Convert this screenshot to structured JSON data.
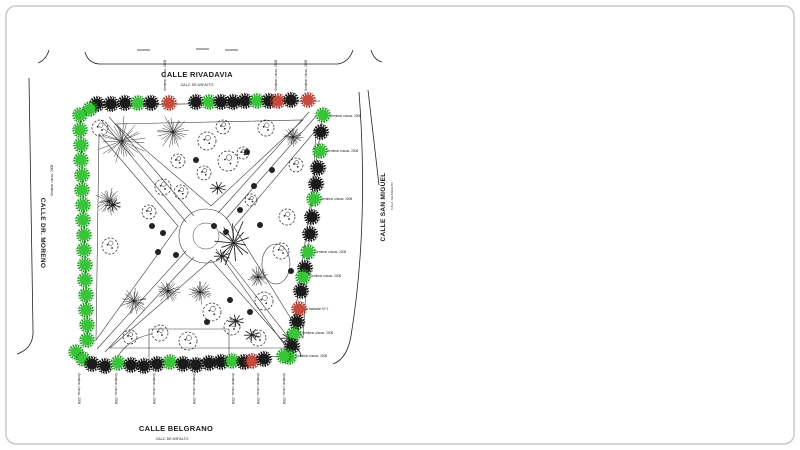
{
  "figure": {
    "palette": {
      "ink": "#222222",
      "faint": "#8a8a8a",
      "frame": "#c9c9c9",
      "K": {
        "fill": "#1b1b1b",
        "ring": "#000000"
      },
      "G": {
        "fill": "#38c53a",
        "ring": "#128a12"
      },
      "R": {
        "fill": "#c74a3c",
        "ring": "#8e2c1f"
      }
    },
    "streets": {
      "north": {
        "name": "CALLE RIVADAVIA",
        "subtitle": "CALZ. DE ASFALTO",
        "x": 197,
        "y": 77,
        "subx": 197,
        "suby": 86
      },
      "south": {
        "name": "CALLE BELGRANO",
        "subtitle": "CALZ. DE ASFALTO",
        "x": 176,
        "y": 431,
        "subx": 172,
        "suby": 440
      },
      "east": {
        "name": "CALLE SAN MIGUEL",
        "subtitle": "CALZ. DE ASFALTO",
        "x": 385,
        "y": 207,
        "subx": 393,
        "suby": 196
      },
      "west": {
        "name": "CALLE DR. MORENO",
        "subtitle": "",
        "x": 41,
        "y": 233,
        "subx": 0,
        "suby": 0
      }
    },
    "annotations": {
      "plant_label": "Sembrar c/acac. 2008",
      "transplant_label": "A trasladar Nº 2"
    },
    "perimeter_trees": {
      "top": [
        [
          97,
          104,
          "K"
        ],
        [
          111,
          104,
          "K"
        ],
        [
          125,
          103,
          "K"
        ],
        [
          138,
          103,
          "G"
        ],
        [
          151,
          103,
          "K"
        ],
        [
          169,
          103,
          "R"
        ],
        [
          196,
          102,
          "K"
        ],
        [
          209,
          102,
          "G"
        ],
        [
          221,
          102,
          "K"
        ],
        [
          233,
          102,
          "K"
        ],
        [
          245,
          101,
          "K"
        ],
        [
          257,
          101,
          "G"
        ],
        [
          269,
          101,
          "K"
        ],
        [
          278,
          101,
          "R"
        ],
        [
          291,
          100,
          "K"
        ],
        [
          308,
          100,
          "R"
        ]
      ],
      "right": [
        [
          323,
          115,
          "G"
        ],
        [
          321,
          132,
          "K"
        ],
        [
          320,
          151,
          "G"
        ],
        [
          318,
          168,
          "K"
        ],
        [
          316,
          184,
          "K"
        ],
        [
          314,
          199,
          "G"
        ],
        [
          312,
          217,
          "K"
        ],
        [
          310,
          234,
          "K"
        ],
        [
          308,
          252,
          "G"
        ],
        [
          305,
          268,
          "K"
        ],
        [
          303,
          277,
          "G"
        ],
        [
          301,
          291,
          "K"
        ],
        [
          299,
          309,
          "R"
        ],
        [
          297,
          322,
          "K"
        ],
        [
          294,
          334,
          "G"
        ],
        [
          292,
          346,
          "K"
        ],
        [
          289,
          357,
          "G"
        ]
      ],
      "left": [
        [
          90,
          109,
          "G"
        ],
        [
          80,
          115,
          "G"
        ],
        [
          80,
          130,
          "G"
        ],
        [
          81,
          145,
          "G"
        ],
        [
          81,
          160,
          "G"
        ],
        [
          82,
          175,
          "G"
        ],
        [
          82,
          190,
          "G"
        ],
        [
          83,
          205,
          "G"
        ],
        [
          83,
          220,
          "G"
        ],
        [
          84,
          235,
          "G"
        ],
        [
          84,
          250,
          "G"
        ],
        [
          85,
          265,
          "G"
        ],
        [
          85,
          280,
          "G"
        ],
        [
          86,
          295,
          "G"
        ],
        [
          86,
          310,
          "G"
        ],
        [
          87,
          325,
          "G"
        ],
        [
          87,
          340,
          "G"
        ],
        [
          76,
          352,
          "G"
        ],
        [
          83,
          359,
          "G"
        ]
      ],
      "bottom": [
        [
          92,
          364,
          "K"
        ],
        [
          105,
          366,
          "K"
        ],
        [
          118,
          363,
          "G"
        ],
        [
          131,
          365,
          "K"
        ],
        [
          144,
          366,
          "K"
        ],
        [
          157,
          364,
          "K"
        ],
        [
          170,
          362,
          "G"
        ],
        [
          183,
          364,
          "K"
        ],
        [
          196,
          365,
          "K"
        ],
        [
          209,
          363,
          "K"
        ],
        [
          221,
          362,
          "K"
        ],
        [
          232,
          361,
          "G"
        ],
        [
          244,
          362,
          "K"
        ],
        [
          252,
          361,
          "R"
        ],
        [
          264,
          359,
          "K"
        ],
        [
          284,
          356,
          "G"
        ]
      ]
    },
    "interior": {
      "bursts": [
        [
          122,
          141,
          26
        ],
        [
          173,
          132,
          18
        ],
        [
          109,
          201,
          15
        ],
        [
          134,
          301,
          15
        ],
        [
          168,
          291,
          13
        ],
        [
          200,
          292,
          13
        ],
        [
          258,
          277,
          12
        ],
        [
          293,
          137,
          11
        ]
      ],
      "branch_tree": [
        234,
        243,
        24
      ],
      "canopies": [
        [
          100,
          128,
          8
        ],
        [
          207,
          141,
          9
        ],
        [
          228,
          161,
          10
        ],
        [
          204,
          173,
          7
        ],
        [
          243,
          153,
          6
        ],
        [
          163,
          187,
          8
        ],
        [
          181,
          192,
          7
        ],
        [
          149,
          212,
          7
        ],
        [
          110,
          246,
          8
        ],
        [
          287,
          217,
          8
        ],
        [
          281,
          251,
          8
        ],
        [
          264,
          301,
          9
        ],
        [
          232,
          327,
          8
        ],
        [
          212,
          312,
          9
        ],
        [
          160,
          333,
          8
        ],
        [
          188,
          341,
          9
        ],
        [
          130,
          337,
          7
        ],
        [
          258,
          338,
          8
        ],
        [
          251,
          200,
          6
        ],
        [
          223,
          127,
          7
        ],
        [
          266,
          128,
          8
        ],
        [
          296,
          165,
          7
        ],
        [
          178,
          161,
          7
        ]
      ],
      "palms": [
        [
          113,
          205
        ],
        [
          218,
          188
        ],
        [
          222,
          256
        ],
        [
          236,
          321
        ],
        [
          252,
          335
        ],
        [
          289,
          338
        ]
      ],
      "dots": [
        [
          247,
          152
        ],
        [
          254,
          186
        ],
        [
          214,
          226
        ],
        [
          226,
          232
        ],
        [
          152,
          226
        ],
        [
          163,
          233
        ],
        [
          250,
          312
        ],
        [
          207,
          322
        ],
        [
          291,
          271
        ],
        [
          272,
          170
        ],
        [
          196,
          160
        ],
        [
          240,
          210
        ],
        [
          176,
          255
        ],
        [
          260,
          225
        ],
        [
          158,
          252
        ],
        [
          230,
          300
        ]
      ]
    },
    "label_positions": {
      "right": [
        {
          "x": 330,
          "y": 117,
          "t": "plant"
        },
        {
          "x": 327,
          "y": 152,
          "t": "plant"
        },
        {
          "x": 321,
          "y": 200,
          "t": "plant"
        },
        {
          "x": 315,
          "y": 253,
          "t": "plant"
        },
        {
          "x": 310,
          "y": 277,
          "t": "plant"
        },
        {
          "x": 306,
          "y": 310,
          "t": "transplant"
        },
        {
          "x": 302,
          "y": 334,
          "t": "plant"
        },
        {
          "x": 296,
          "y": 357,
          "t": "plant"
        }
      ],
      "top": [
        166,
        277,
        307
      ],
      "bottom": [
        78,
        115,
        153,
        193,
        232,
        257,
        283
      ],
      "west": [
        {
          "x": 53,
          "y": 196
        }
      ]
    },
    "paths": {
      "streets": [
        "M85,52 Q88,63 99,64 L338,64 Q349,62 353,50",
        "M49,50 Q46,60 38,63",
        "M371,50 Q374,60 382,62",
        "M137,50 L150,50 M196,49 L209,49 M225,50 L238,50",
        "M29,78 L33,330 Q34,348 17,354",
        "M359,92 Q369,225 351,336 Q347,359 333,364",
        "M368,90 L379,185",
        "M293,346 Q300,348 301,357"
      ],
      "rows": [
        "M90,106 L320,101",
        "M80,113 L88,342",
        "M323,113 L289,358",
        "M90,365 L285,356"
      ],
      "walks": [
        "M101,120 L186,222 M109,117 L194,216",
        "M317,115 L226,219 M309,112 L218,213",
        "M97,349 L186,251 M105,352 L194,257",
        "M299,351 L224,255 M291,354 L216,249",
        "M115,124 L303,120 L211,206 Z",
        "M99,134 L178,226 L96,340 Z",
        "M316,130 L234,227 L303,338 Z",
        "M110,348 L211,260 L289,348 Z",
        "M118,356 Q130,338 152,334",
        "M149,329 h80 v32 h-80 Z",
        "M276,244 a14,20 0 1 1 -0.1,0"
      ],
      "center": {
        "cx": 206,
        "cy": 236,
        "r1": 27,
        "r2": 13
      }
    }
  }
}
